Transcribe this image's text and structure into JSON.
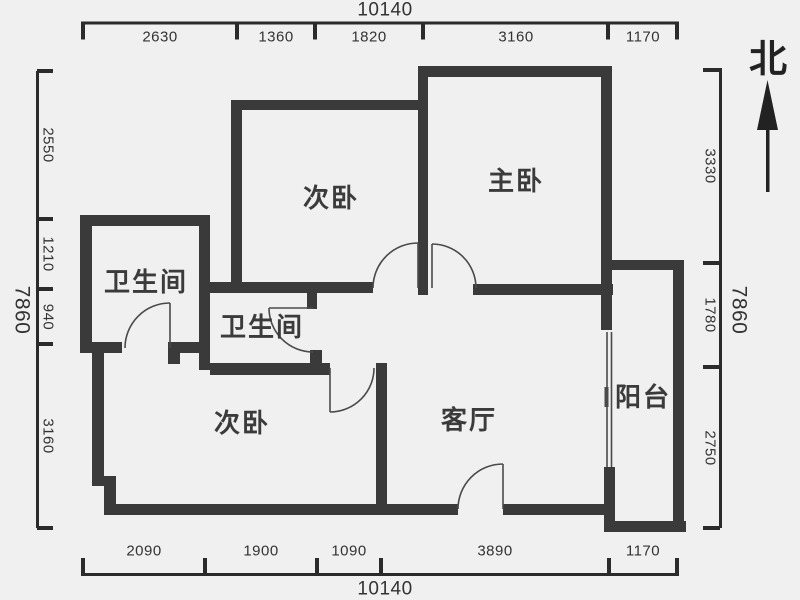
{
  "colors": {
    "background": "#f0f0f0",
    "wall": "#3a3a3a",
    "thin_line": "#4a4a4a",
    "dim_line": "#2b2b2b",
    "text": "#333333"
  },
  "north": {
    "label": "北"
  },
  "rooms": {
    "bedroom_top": "次卧",
    "master_bedroom": "主卧",
    "bathroom_left": "卫生间",
    "bathroom_middle": "卫生间",
    "bedroom_bottom": "次卧",
    "living_room": "客厅",
    "balcony": "阳台"
  },
  "dimensions": {
    "top": {
      "total": "10140",
      "segments": [
        "2630",
        "1360",
        "1820",
        "3160",
        "1170"
      ]
    },
    "bottom": {
      "total": "10140",
      "segments": [
        "2090",
        "1900",
        "1090",
        "3890",
        "1170"
      ]
    },
    "left": {
      "total": "7860",
      "segments": [
        "2550",
        "1210",
        "940",
        "3160"
      ]
    },
    "right": {
      "total": "7860",
      "segments": [
        "3330",
        "1780",
        "2750"
      ]
    }
  }
}
